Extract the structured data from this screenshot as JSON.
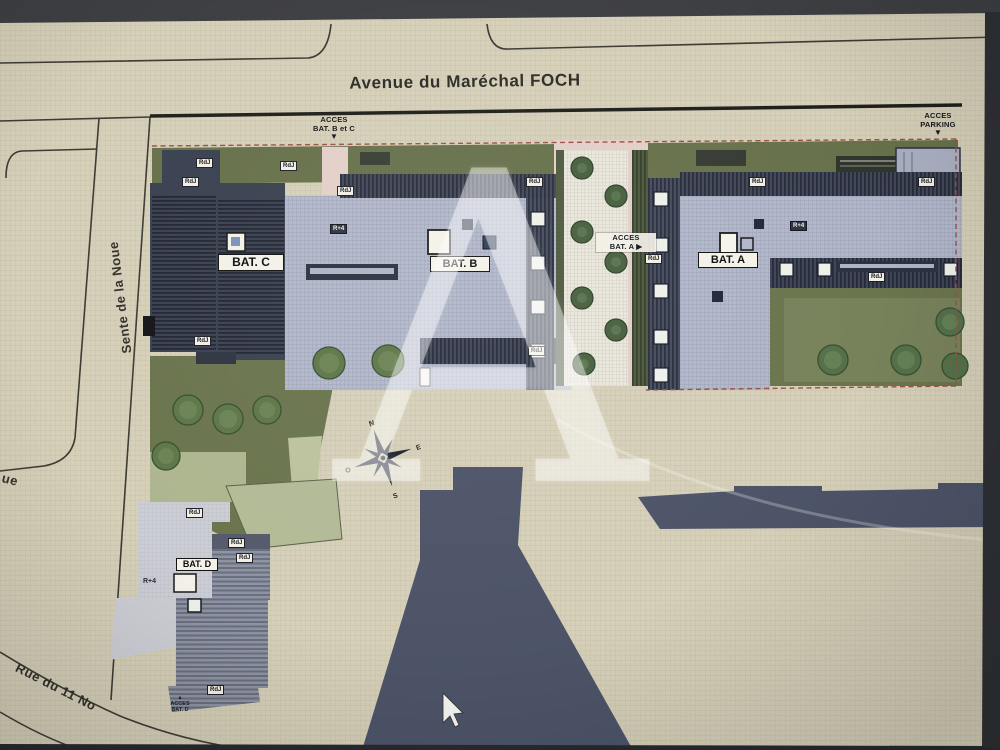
{
  "title": "Avenue du Maréchal FOCH",
  "streets": {
    "left": "Sente de la Noue",
    "left_partial": "ue",
    "bottom": "Rue du 11 No"
  },
  "access": {
    "bc": {
      "line1": "ACCES",
      "line2": "BAT. B et C",
      "arrow": "▼"
    },
    "parking": {
      "line1": "ACCES",
      "line2": "PARKING",
      "arrow": "▼"
    },
    "a": {
      "line1": "ACCES",
      "line2": "BAT. A ▶"
    },
    "d": {
      "arrow": "▲",
      "line1": "ACCES",
      "line2": "BAT. D"
    }
  },
  "buildings": {
    "a": "BAT. A",
    "b": "BAT. B",
    "c": "BAT. C",
    "d": "BAT. D"
  },
  "tags": {
    "rdj": "RdJ",
    "r4": "R+4"
  },
  "compass": {
    "n": "N",
    "e": "E",
    "s": "S",
    "o": "O"
  },
  "watermark": "A",
  "colors": {
    "paper": "#d6d0b9",
    "dark_roof": "#3a4150",
    "light_roof": "#b2b8ca",
    "olive_green": "#6a744d",
    "sage_green": "#aeb690",
    "pink_path": "#e2cfc8",
    "slate_building": "#4d5468",
    "boundary_dash": "#9c5148",
    "tree_green": "#5e7649"
  }
}
